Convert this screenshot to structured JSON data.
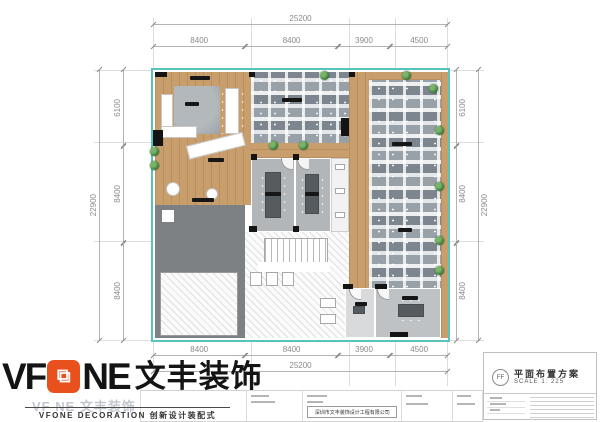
{
  "dims": {
    "top": {
      "total": "25200",
      "segs": [
        "8400",
        "8400",
        "3900",
        "4500"
      ]
    },
    "bottom": {
      "total": "25200",
      "segs": [
        "8400",
        "8400",
        "3900",
        "4500"
      ]
    },
    "left": {
      "total": "22900",
      "segs": [
        "6100",
        "8400",
        "8400"
      ]
    },
    "right": {
      "total": "22900",
      "segs": [
        "6100",
        "8400",
        "8400"
      ]
    }
  },
  "branding": {
    "logo_vf": "VF",
    "logo_ne": "NE",
    "logo_cn": "文丰装饰",
    "logo_cube_glyph": "⧉",
    "watermark": "VF NE 文丰装饰",
    "tagline": "VFONE DECORATION 创新设计装配式"
  },
  "title_block": {
    "marker": "FF",
    "title": "平面布置方案",
    "scale": "SCALE 1: 225",
    "company": "深圳市文丰装饰设计工程有限公司"
  },
  "colors": {
    "accent_orange": "#E8511D",
    "plan_border_teal": "#58C2BC",
    "wood_floor": "#C99E6D",
    "office_floor_gray": "#B3B6B9",
    "undeveloped_gray": "#7E8183"
  }
}
